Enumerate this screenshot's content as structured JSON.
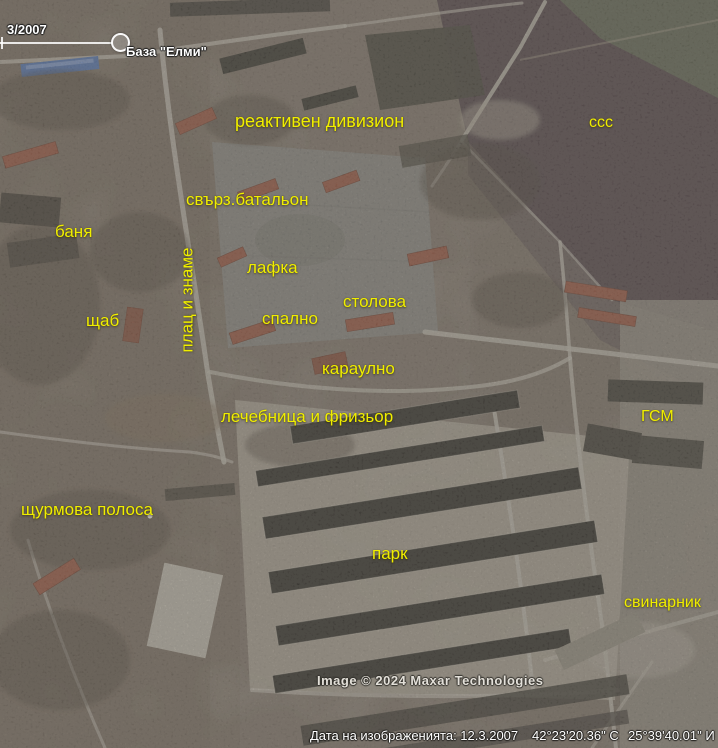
{
  "timeline": {
    "date": "3/2007"
  },
  "labels": {
    "base": "База \"Елми\"",
    "reaktiven_divizion": "реактивен дивизион",
    "sss": "ссс",
    "svarz_batalyon": "свърз.батальон",
    "banya": "баня",
    "lafka": "лафка",
    "stolova": "столова",
    "spalno": "спално",
    "shtab": "щаб",
    "plats_i_zname": "плац и знаме",
    "karaulno": "караулно",
    "lechebnitsa_i_frizior": "лечебница и фризьор",
    "gsm": "ГСМ",
    "shturmova_polosa": "щурмова полоса",
    "park": "парк",
    "svinarnik": "свинарник"
  },
  "copyright": "Image © 2024 Maxar Technologies",
  "status_bar": {
    "imagery_date": "Дата на изображенията: 12.3.2007",
    "latitude": "42°23'20.36\" С",
    "longitude": "25°39'40.01\" И"
  },
  "colors": {
    "annotation_yellow": "#f0ee00",
    "placemark_white": "#ffffff"
  }
}
